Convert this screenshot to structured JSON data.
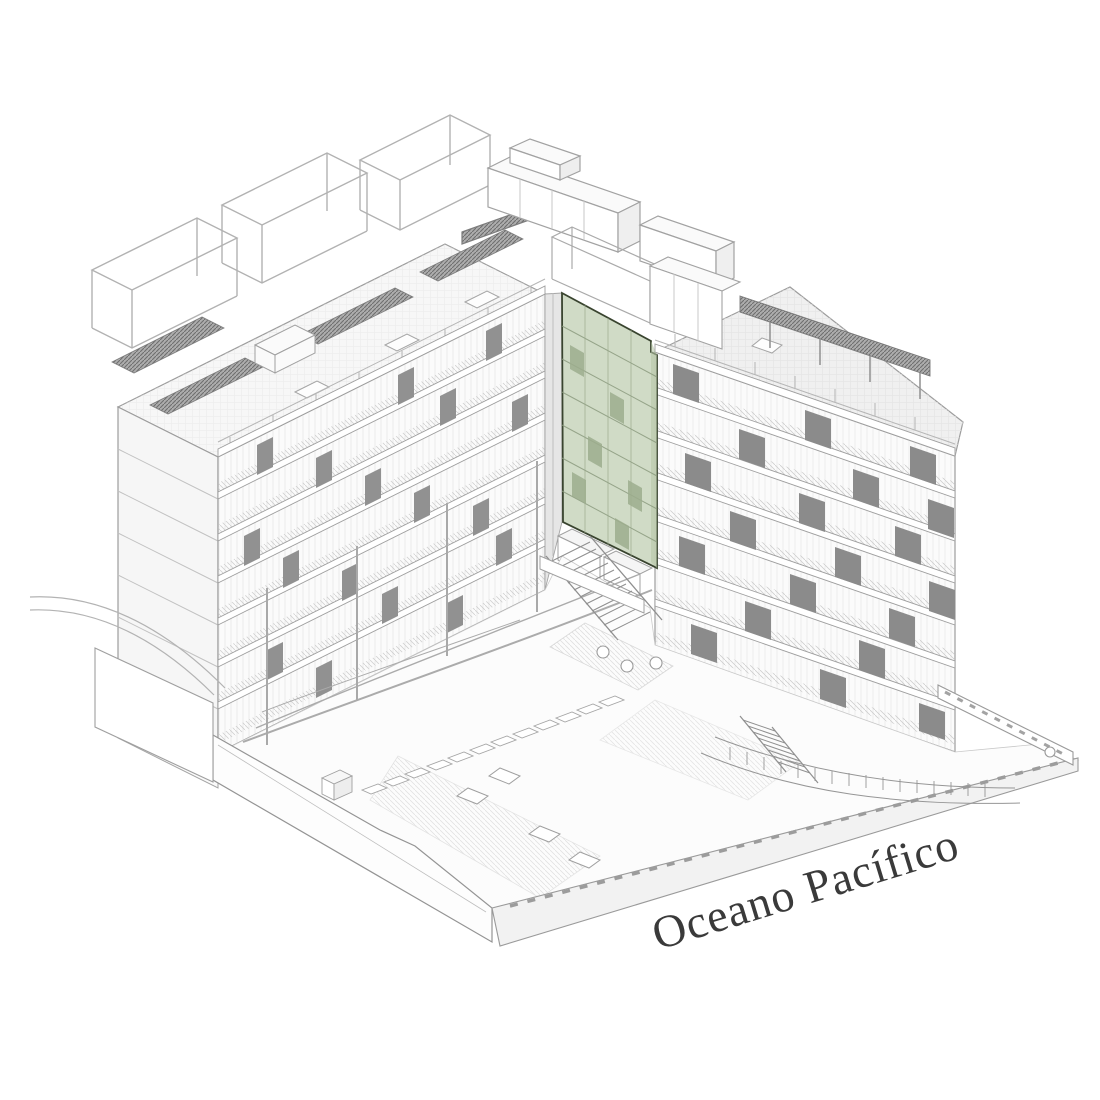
{
  "label": {
    "text": "Oceano Pacífico",
    "rotation_deg": -17,
    "color": "#3a3a3a",
    "font_px": 46
  },
  "highlight": {
    "name": "selected-corner-unit-facade",
    "fill": "#ccd8c1",
    "panel_fill": "#9cad8d",
    "outline": "#39442f"
  },
  "palette": {
    "background": "#ffffff",
    "line_light": "#b5b5b5",
    "line_mid": "#9e9e9e",
    "line_dark": "#7d7d7d",
    "facade_fill": "#fbfbfb",
    "roof_fill": "#f1f1f1",
    "panel_dark": "#8f8f8f",
    "wall_fill": "#fdfdfd"
  },
  "scene": {
    "parts": [
      "left-residential-slab",
      "right-residential-tower",
      "highlighted-corner-facade",
      "rooftop-pergolas",
      "penthouse-volumes",
      "plaza-with-ramps",
      "grand-stair",
      "terraced-steps",
      "ocean-promenade"
    ]
  }
}
